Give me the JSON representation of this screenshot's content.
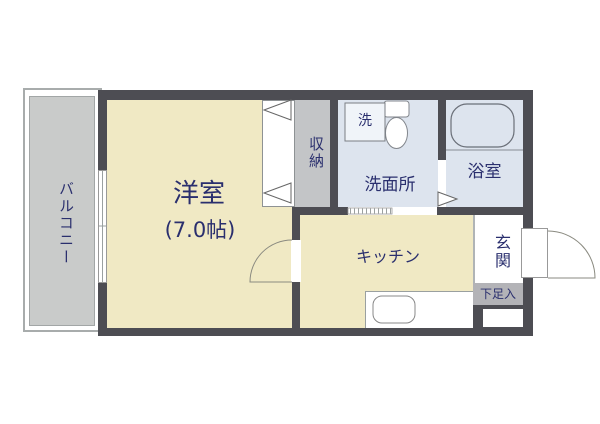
{
  "floorplan": {
    "rooms": {
      "balcony": {
        "label": "バルコニー"
      },
      "western_room": {
        "label": "洋室",
        "size": "(7.0帖)"
      },
      "closet": {
        "label": "収納"
      },
      "washroom": {
        "label": "洗面所"
      },
      "washing_machine": {
        "label": "洗"
      },
      "bathroom": {
        "label": "浴室"
      },
      "kitchen": {
        "label": "キッチン"
      },
      "entrance": {
        "label": "玄関"
      },
      "shoe_box": {
        "label": "下足入"
      }
    },
    "colors": {
      "wall": "#4d4d53",
      "room_cream": "#f0e9c4",
      "wet_area_blue": "#dde4ee",
      "balcony_gray": "#c9cbca",
      "closet_gray": "#c3c5c7",
      "shoe_box_gray": "#b3b3b7",
      "label_navy": "#2a2f6e",
      "fixture_line": "#82868c"
    }
  }
}
